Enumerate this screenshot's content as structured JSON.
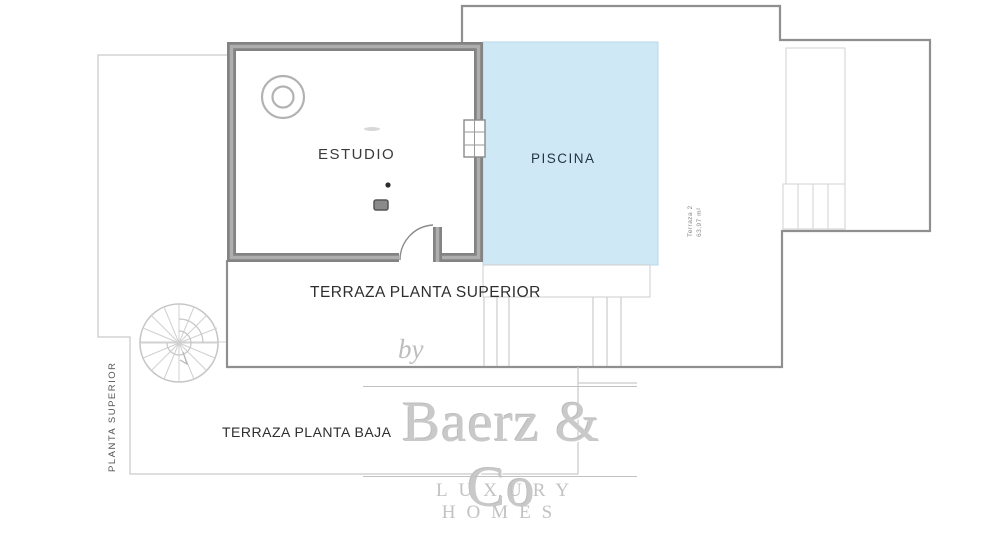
{
  "plan": {
    "rooms": {
      "estudio": "ESTUDIO",
      "piscina": "PISCINA"
    },
    "labels": {
      "terraza_superior": "TERRAZA PLANTA SUPERIOR",
      "terraza_baja": "TERRAZA PLANTA BAJA",
      "planta_superior": "PLANTA SUPERIOR",
      "terraza2_name": "Terraza 2",
      "terraza2_area": "63,97 m²"
    },
    "colors": {
      "pool_fill": "#cfe8f5",
      "pool_border": "#b9d9e8",
      "pool_text": "#22364a",
      "wall_dark": "#838383",
      "wall_light": "#aeaeae",
      "outline_dark": "#8f8f8f",
      "outline_light": "#c9c9c9",
      "watermark": "#c6c6c6"
    }
  },
  "watermark": {
    "by": "by",
    "brand": "Baerz & Co",
    "tagline": "LUXURY HOMES"
  }
}
